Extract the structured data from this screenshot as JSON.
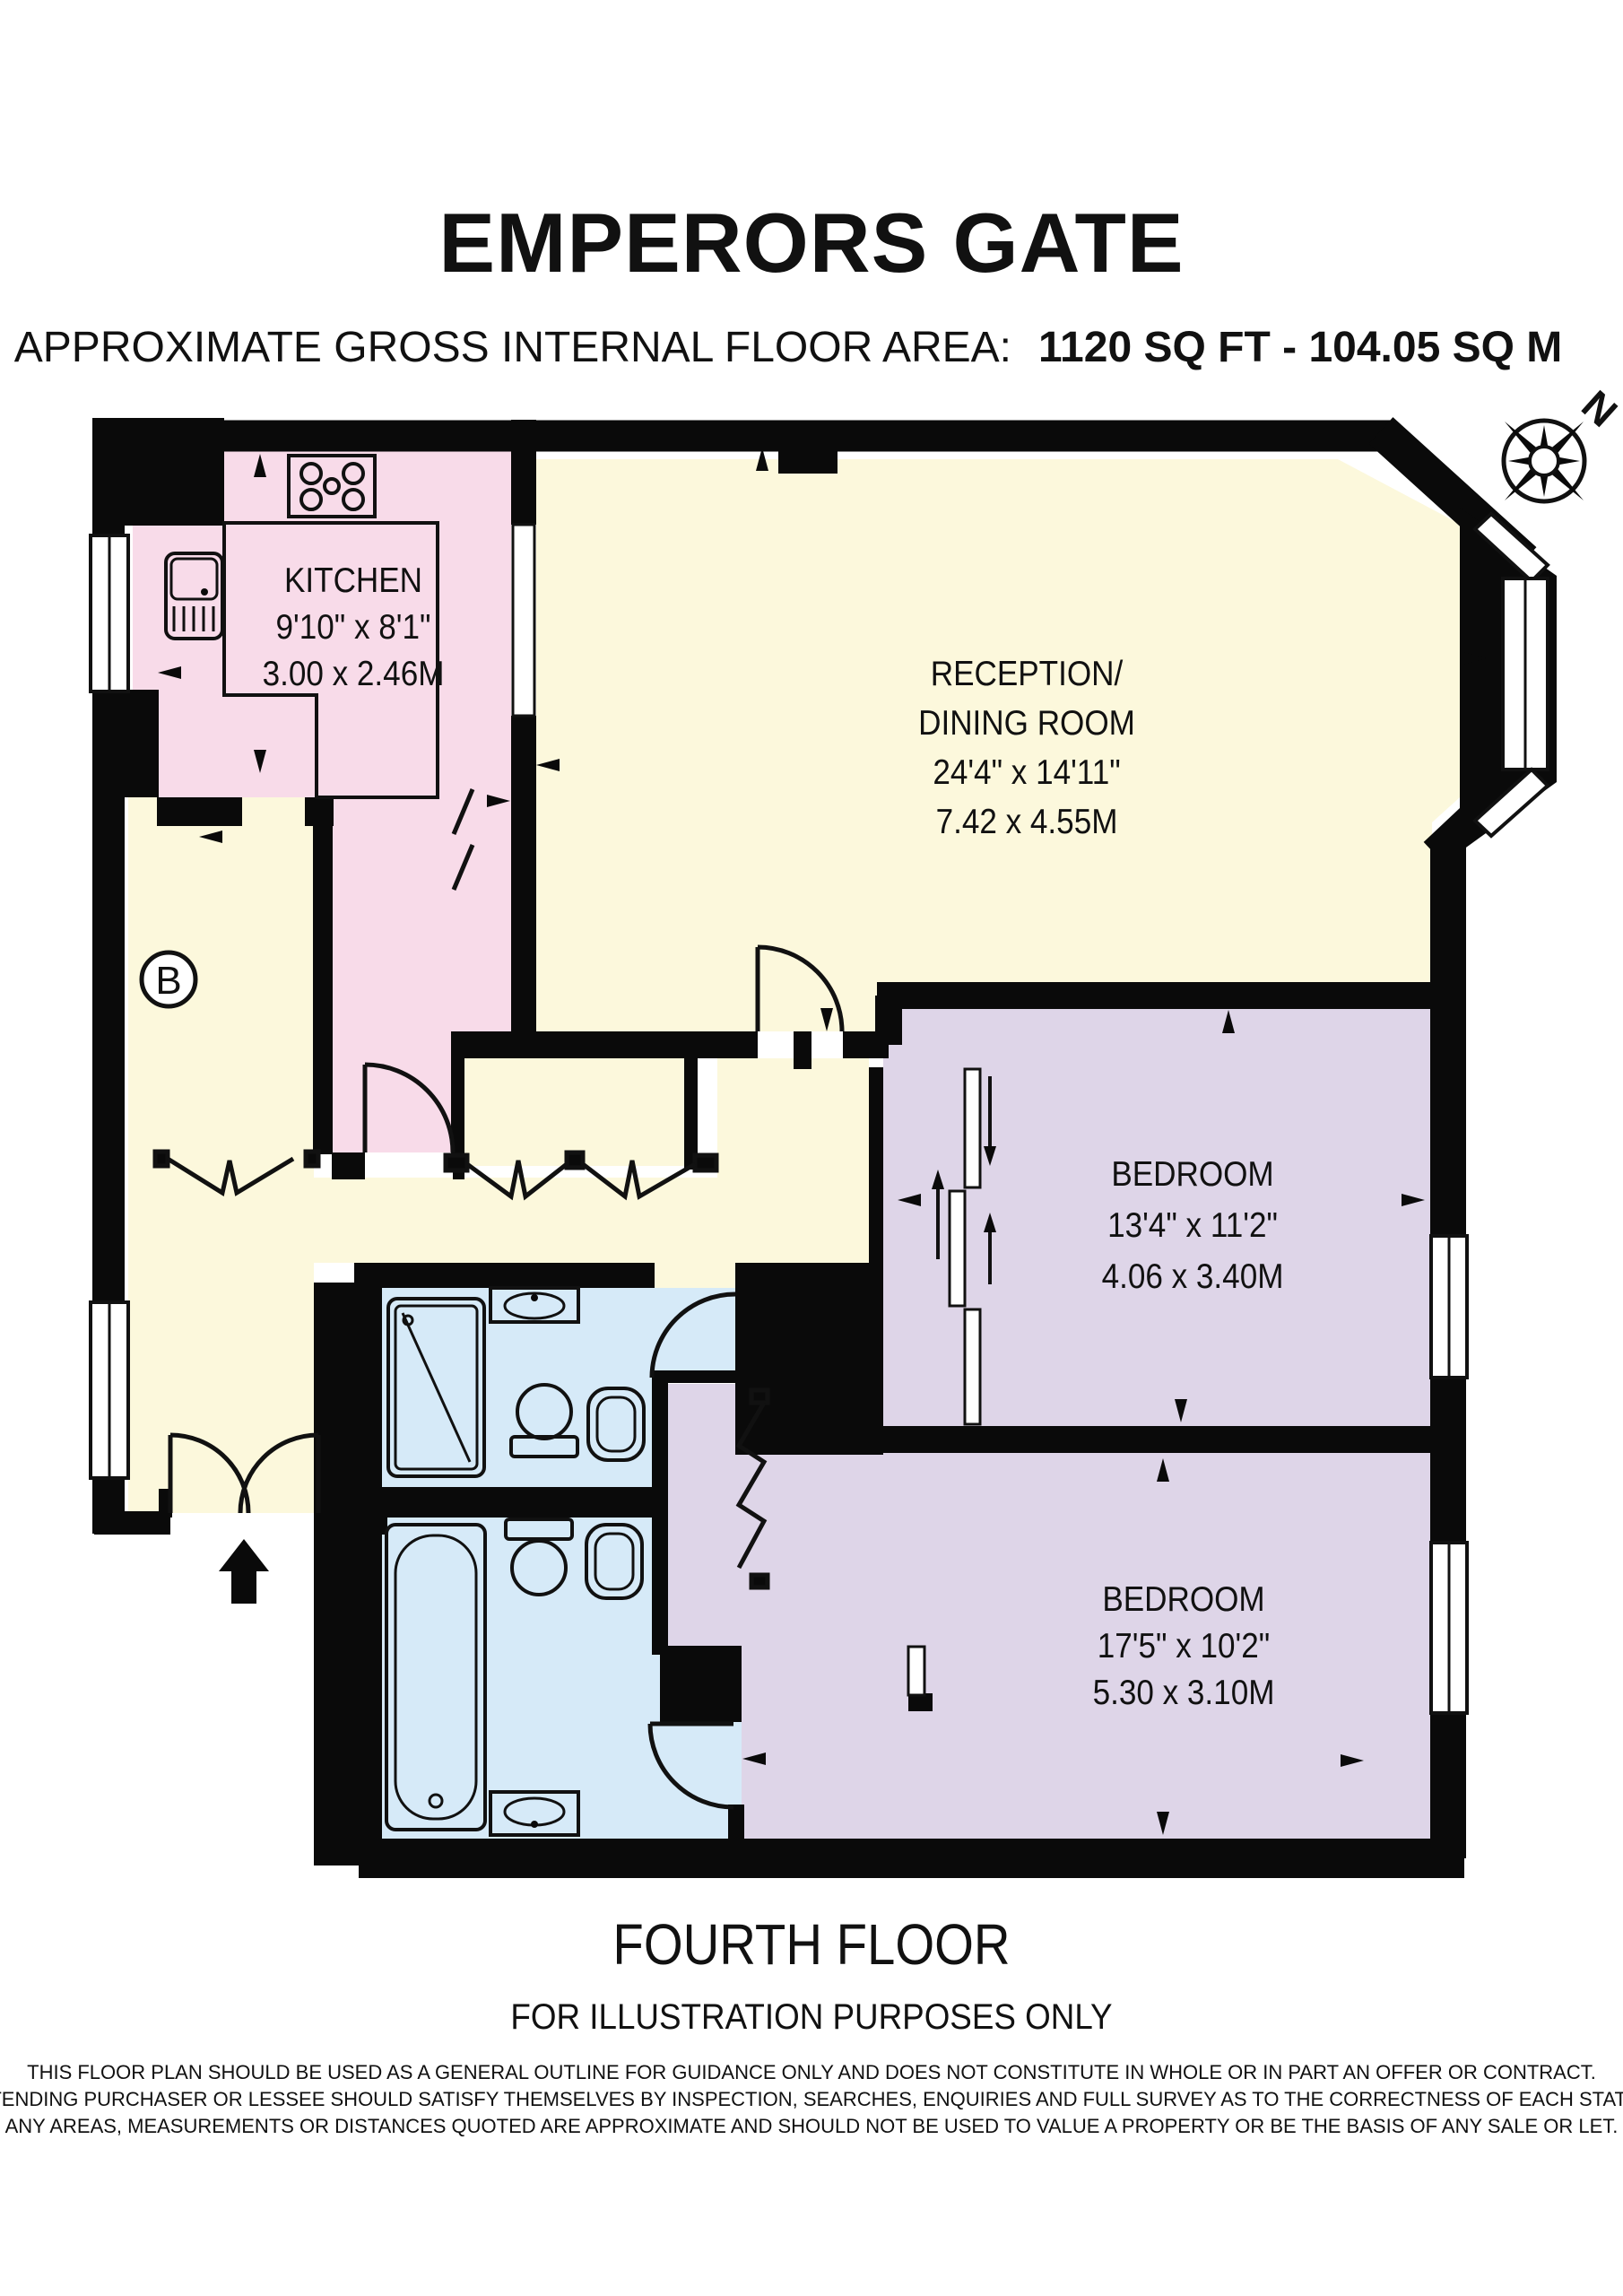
{
  "header": {
    "title": "EMPERORS GATE",
    "area_label": "APPROXIMATE GROSS INTERNAL FLOOR AREA:",
    "area_value": "1120 SQ FT - 104.05 SQ M"
  },
  "compass": {
    "north_label": "N"
  },
  "plan": {
    "block_label": "B"
  },
  "rooms": {
    "kitchen": {
      "name": "KITCHEN",
      "imperial": "9'10\" x 8'1\"",
      "metric": "3.00 x 2.46M"
    },
    "reception": {
      "name_line1": "RECEPTION/",
      "name_line2": "DINING ROOM",
      "imperial": "24'4\" x 14'11\"",
      "metric": "7.42 x 4.55M"
    },
    "bedroom1": {
      "name": "BEDROOM",
      "imperial": "13'4\" x 11'2\"",
      "metric": "4.06 x 3.40M"
    },
    "bedroom2": {
      "name": "BEDROOM",
      "imperial": "17'5\" x 10'2\"",
      "metric": "5.30 x 3.10M"
    }
  },
  "footer": {
    "floor_label": "FOURTH FLOOR",
    "note": "FOR ILLUSTRATION PURPOSES ONLY",
    "disclaimer": [
      "THIS FLOOR PLAN SHOULD BE USED AS A GENERAL OUTLINE FOR GUIDANCE ONLY AND DOES NOT CONSTITUTE IN WHOLE OR IN PART AN OFFER OR CONTRACT.",
      "ANY INTENDING PURCHASER OR LESSEE SHOULD SATISFY THEMSELVES BY INSPECTION, SEARCHES, ENQUIRIES AND FULL SURVEY AS TO THE CORRECTNESS OF EACH STATEMENT.",
      "ANY AREAS, MEASUREMENTS OR DISTANCES QUOTED ARE APPROXIMATE AND SHOULD NOT BE USED TO VALUE A PROPERTY OR BE THE BASIS OF ANY SALE OR LET."
    ]
  },
  "colors": {
    "wall": "#0a0a0a",
    "kitchen": "#f8dbe9",
    "reception_hall": "#fcf8dc",
    "bedroom": "#ded5e8",
    "bathroom": "#d6eaf8"
  }
}
